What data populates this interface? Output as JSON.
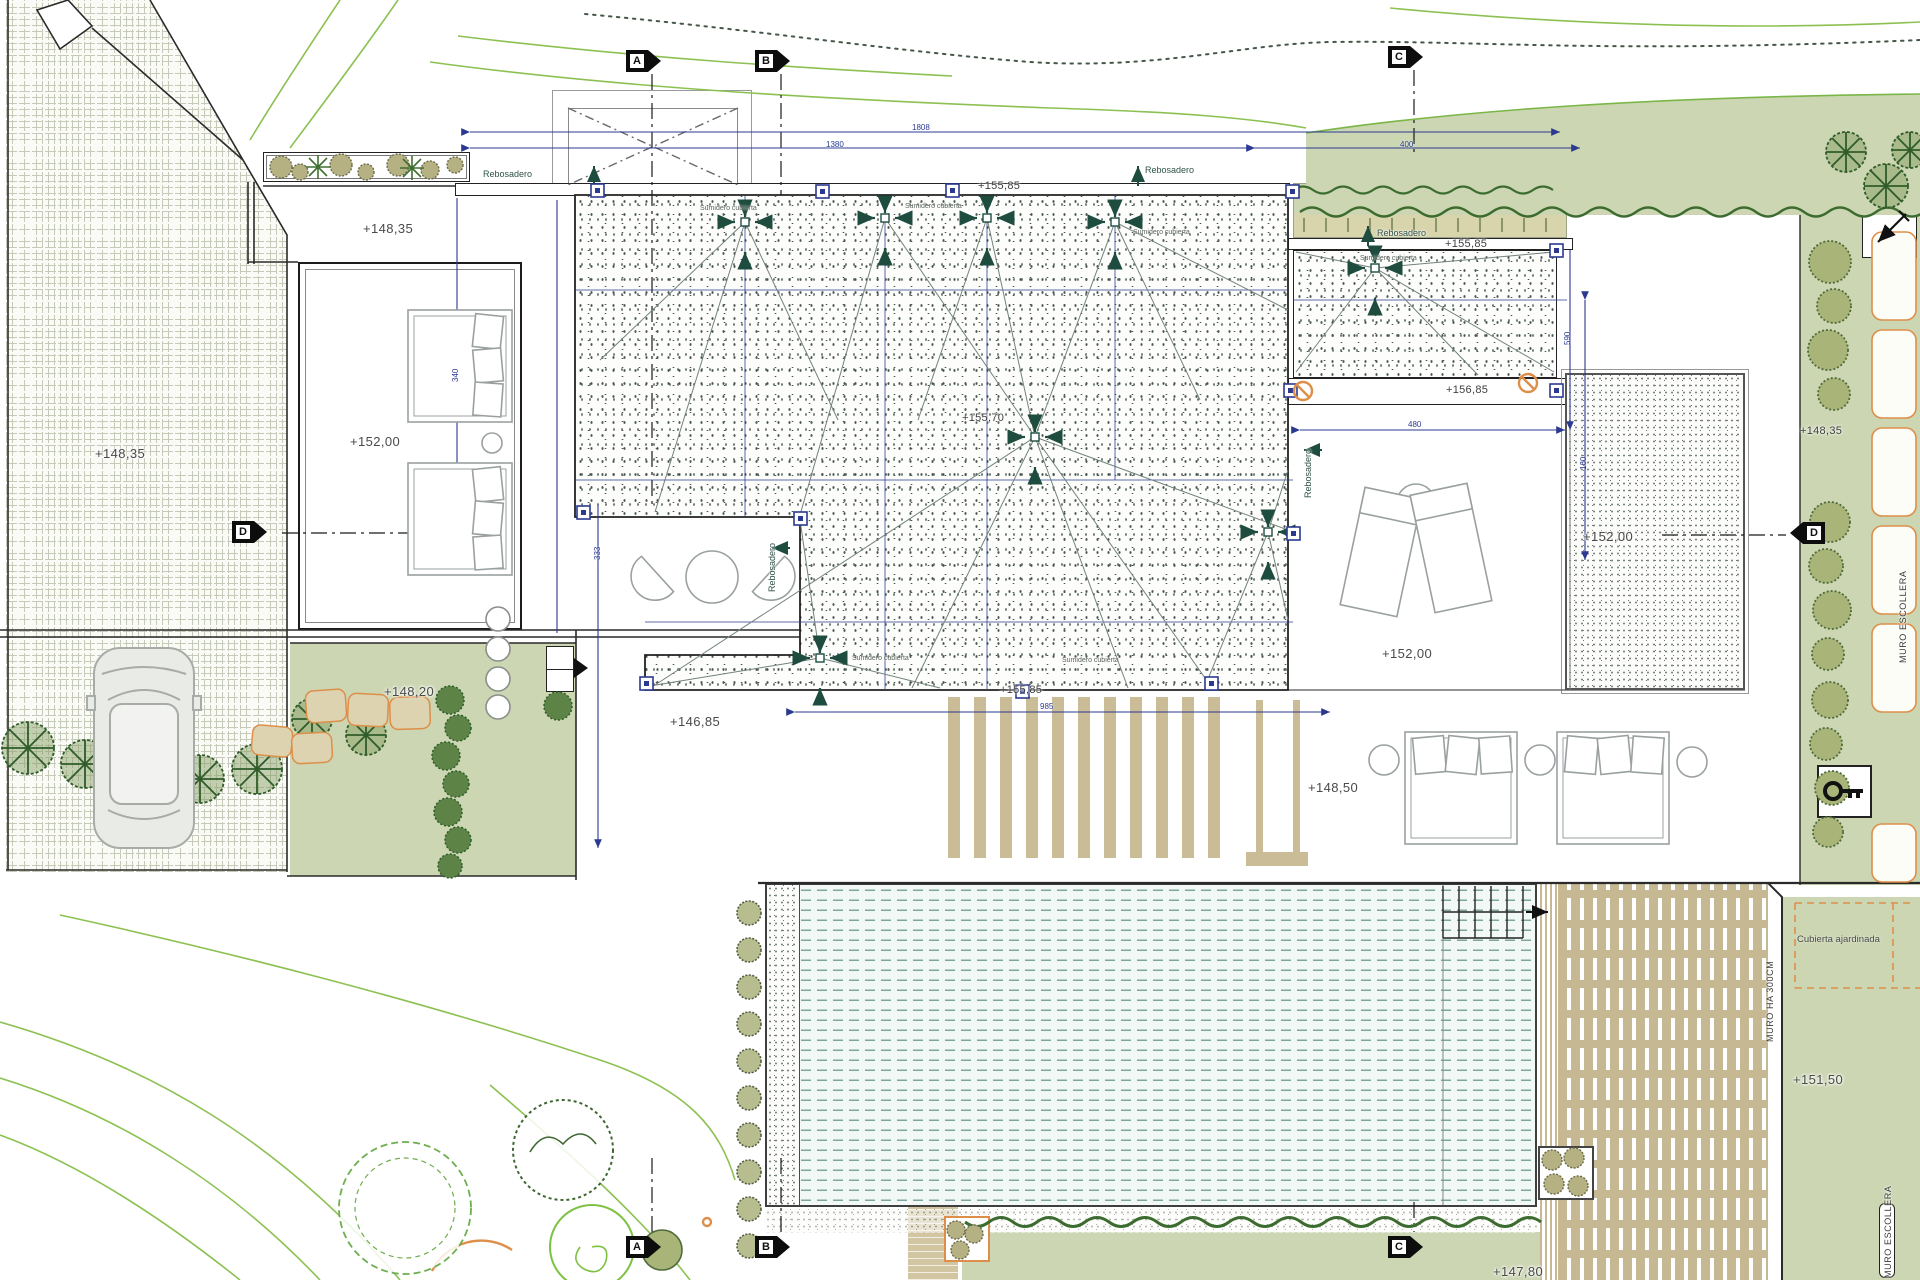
{
  "document": {
    "kind": "architectural roof and landscape site plan",
    "language": "Spanish"
  },
  "colors": {
    "paper": "#ffffff",
    "dimension_blue": "#2b3990",
    "drain_teal": "#1e4d40",
    "vegetation_green": "#ccd6b2",
    "hedge_dark": "#3c6b2f",
    "contour_green": "#8cc152",
    "wood_tan": "#c6b892",
    "accent_orange": "#dd8f4a",
    "water_dash": "#7fa69e"
  },
  "text_items": [
    {
      "id": "level-driveway",
      "cls": "elev",
      "x": 95,
      "y": 447,
      "text": "+148,35"
    },
    {
      "id": "level-courtyard",
      "cls": "elev",
      "x": 363,
      "y": 222,
      "text": "+148,35"
    },
    {
      "id": "level-room-terrace",
      "cls": "elev",
      "x": 350,
      "y": 435,
      "text": "+152,00"
    },
    {
      "id": "level-lawn",
      "cls": "elev",
      "x": 384,
      "y": 685,
      "text": "+148,20"
    },
    {
      "id": "level-lower-court",
      "cls": "elev",
      "x": 670,
      "y": 715,
      "text": "+146,85"
    },
    {
      "id": "level-parapet",
      "cls": "elev-sm",
      "x": 978,
      "y": 181,
      "text": "+155,85"
    },
    {
      "id": "level-roof-center",
      "cls": "elev-sm",
      "x": 962,
      "y": 413,
      "text": "+155,70"
    },
    {
      "id": "level-roof-south",
      "cls": "elev-sm",
      "x": 1000,
      "y": 685,
      "text": "+155,85"
    },
    {
      "id": "level-wing-roof",
      "cls": "elev-sm",
      "x": 1445,
      "y": 239,
      "text": "+155,85"
    },
    {
      "id": "level-wing-strip",
      "cls": "elev-sm",
      "x": 1446,
      "y": 385,
      "text": "+156,85"
    },
    {
      "id": "level-terrace-right",
      "cls": "elev",
      "x": 1382,
      "y": 647,
      "text": "+152,00"
    },
    {
      "id": "level-garden-square",
      "cls": "elev",
      "x": 1583,
      "y": 530,
      "text": "+152,00"
    },
    {
      "id": "level-sunbed-terrace",
      "cls": "elev",
      "x": 1308,
      "y": 781,
      "text": "+148,50"
    },
    {
      "id": "level-right-strip",
      "cls": "elev-sm",
      "x": 1800,
      "y": 426,
      "text": "+148,35"
    },
    {
      "id": "level-green-roof",
      "cls": "elev",
      "x": 1793,
      "y": 1073,
      "text": "+151,50"
    },
    {
      "id": "level-bottom",
      "cls": "elev",
      "x": 1493,
      "y": 1265,
      "text": "+147,80"
    },
    {
      "id": "rebosadero-1",
      "cls": "rebo",
      "x": 483,
      "y": 170,
      "text": "Rebosadero"
    },
    {
      "id": "rebosadero-2",
      "cls": "rebo",
      "x": 1145,
      "y": 166,
      "text": "Rebosadero"
    },
    {
      "id": "rebosadero-3",
      "cls": "rebo",
      "x": 1377,
      "y": 229,
      "text": "Rebosadero"
    },
    {
      "id": "rebosadero-4",
      "cls": "rebo",
      "x": 768,
      "y": 592,
      "rot": -90,
      "text": "Rebosadero"
    },
    {
      "id": "rebosadero-5",
      "cls": "rebo",
      "x": 1304,
      "y": 498,
      "rot": -90,
      "text": "Rebosadero"
    },
    {
      "id": "sumidero-1",
      "cls": "sumi",
      "x": 700,
      "y": 205,
      "text": "Sumidero cubierta"
    },
    {
      "id": "sumidero-2",
      "cls": "sumi",
      "x": 905,
      "y": 203,
      "text": "Sumidero cubierta"
    },
    {
      "id": "sumidero-3",
      "cls": "sumi",
      "x": 1133,
      "y": 229,
      "text": "Sumidero cubierta"
    },
    {
      "id": "sumidero-4",
      "cls": "sumi",
      "x": 1360,
      "y": 255,
      "text": "Sumidero cubierta"
    },
    {
      "id": "sumidero-5",
      "cls": "sumi",
      "x": 852,
      "y": 655,
      "text": "Sumidero cubierta"
    },
    {
      "id": "sumidero-6",
      "cls": "sumi",
      "x": 1062,
      "y": 657,
      "text": "Sumidero cubierta"
    },
    {
      "id": "muro-escollera",
      "cls": "muro",
      "x": 1899,
      "y": 663,
      "rot": -90,
      "text": "MURO ESCOLLERA"
    },
    {
      "id": "muro-ha-300",
      "cls": "muro",
      "x": 1766,
      "y": 1042,
      "rot": -90,
      "text": "MURO HA 300CM"
    },
    {
      "id": "muro-escollera-2",
      "cls": "muro",
      "x": 1884,
      "y": 1278,
      "rot": -90,
      "text": "MURO ESCOLLERA"
    },
    {
      "id": "cubierta-ajardinada",
      "cls": "cubierta",
      "x": 1797,
      "y": 935,
      "text": "Cubierta ajardinada"
    },
    {
      "id": "dim-1808",
      "cls": "dim",
      "x": 912,
      "y": 124,
      "text": "1808"
    },
    {
      "id": "dim-1380",
      "cls": "dim",
      "x": 826,
      "y": 141,
      "text": "1380"
    },
    {
      "id": "dim-400",
      "cls": "dim",
      "x": 1400,
      "y": 141,
      "text": "400"
    },
    {
      "id": "dim-985",
      "cls": "dim",
      "x": 1040,
      "y": 703,
      "text": "985"
    },
    {
      "id": "dim-480",
      "cls": "dim",
      "x": 1408,
      "y": 421,
      "text": "480"
    },
    {
      "id": "dim-340",
      "cls": "dim",
      "x": 452,
      "y": 382,
      "rot": -90,
      "text": "340"
    },
    {
      "id": "dim-333",
      "cls": "dim",
      "x": 594,
      "y": 560,
      "rot": -90,
      "text": "333"
    },
    {
      "id": "dim-590",
      "cls": "dim",
      "x": 1564,
      "y": 345,
      "rot": -90,
      "text": "590"
    },
    {
      "id": "dim-160",
      "cls": "dim",
      "x": 1580,
      "y": 470,
      "rot": -90,
      "text": "160"
    }
  ],
  "section_markers": [
    {
      "id": "section-a-top",
      "letter": "A",
      "x": 626,
      "y": 50,
      "dir": "right"
    },
    {
      "id": "section-b-top",
      "letter": "B",
      "x": 755,
      "y": 50,
      "dir": "right"
    },
    {
      "id": "section-c-top",
      "letter": "C",
      "x": 1388,
      "y": 46,
      "dir": "right"
    },
    {
      "id": "section-d-left",
      "letter": "D",
      "x": 232,
      "y": 521,
      "dir": "right"
    },
    {
      "id": "section-d-right",
      "letter": "D",
      "x": 1790,
      "y": 522,
      "dir": "left"
    },
    {
      "id": "section-a-bottom",
      "letter": "A",
      "x": 626,
      "y": 1236,
      "dir": "right"
    },
    {
      "id": "section-b-bottom",
      "letter": "B",
      "x": 755,
      "y": 1236,
      "dir": "right"
    },
    {
      "id": "section-c-bottom",
      "letter": "C",
      "x": 1388,
      "y": 1236,
      "dir": "right"
    }
  ],
  "layout_constants": {
    "pergola_slat_count": 11
  }
}
